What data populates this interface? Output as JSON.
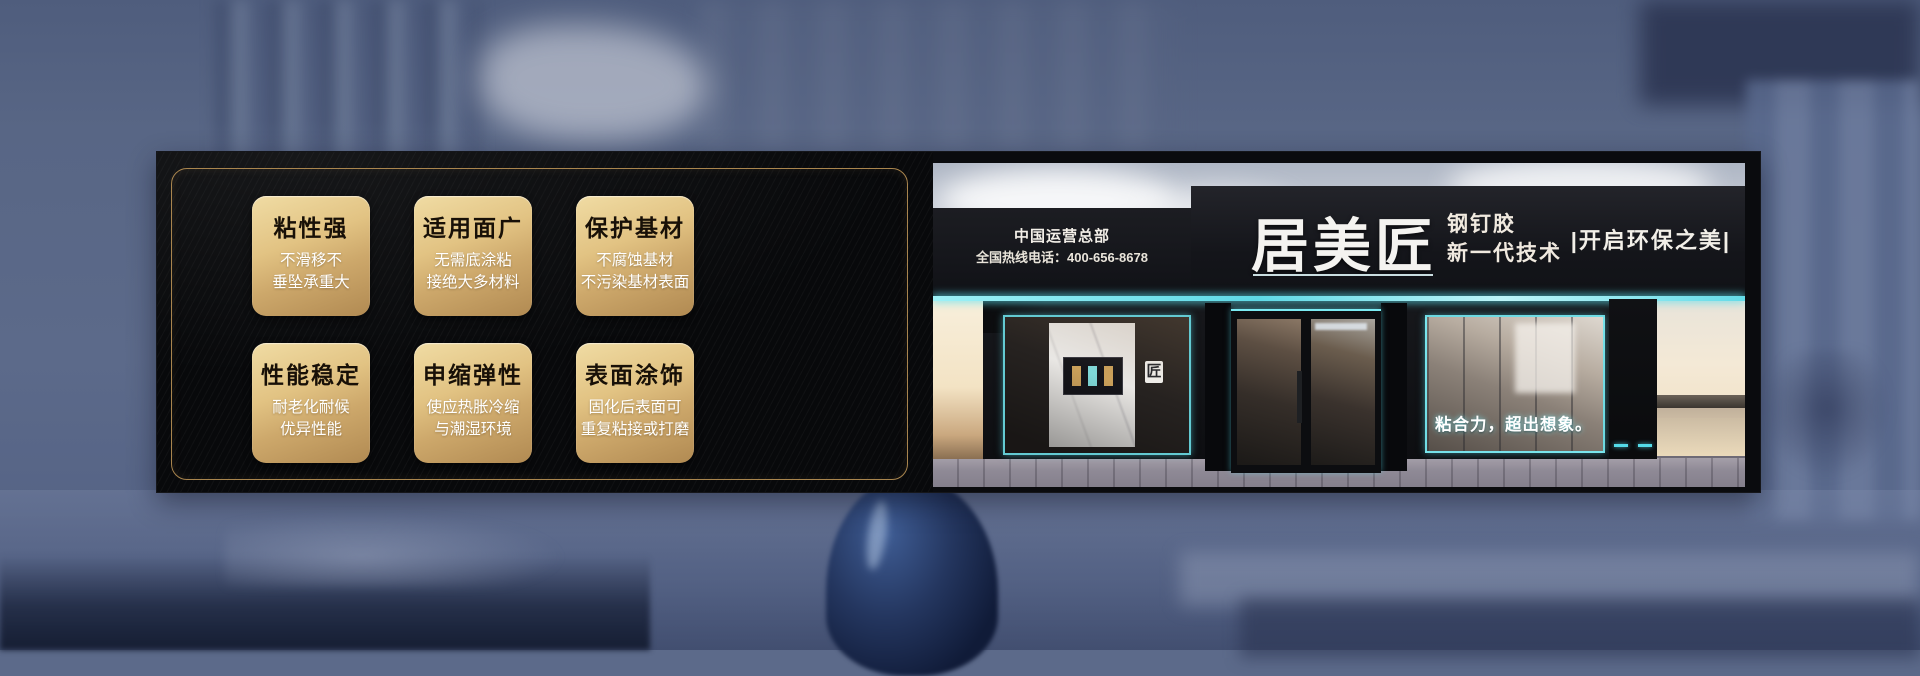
{
  "banner": {
    "features": {
      "cards": [
        {
          "title": "粘性强",
          "line1": "不滑移不",
          "line2": "垂坠承重大"
        },
        {
          "title": "适用面广",
          "line1": "无需底涂粘",
          "line2": "接绝大多材料"
        },
        {
          "title": "保护基材",
          "line1": "不腐蚀基材",
          "line2": "不污染基材表面"
        },
        {
          "title": "性能稳定",
          "line1": "耐老化耐候",
          "line2": "优异性能"
        },
        {
          "title": "申缩弹性",
          "line1": "使应热胀冷缩",
          "line2": "与潮湿环境"
        },
        {
          "title": "表面涂饰",
          "line1": "固化后表面可",
          "line2": "重复粘接或打磨"
        }
      ]
    },
    "storefront": {
      "hq_label": "中国运营总部",
      "hotline": "全国热线电话：400-656-8678",
      "brand": "居美匠",
      "product_line1": "钢钉胶",
      "product_line2": "新一代技术",
      "right_slogan": "|开启环保之美|",
      "window_slogan": "粘合力，超出想象。",
      "inner_logo": "匠"
    }
  },
  "colors": {
    "accent_teal": "#6FE8F2",
    "gold_border": "#A9854E",
    "card_gold_light": "#F0DCA4",
    "card_gold_dark": "#B18A52",
    "panel_black": "#08090B",
    "background_blue": "#5C6A8A"
  }
}
